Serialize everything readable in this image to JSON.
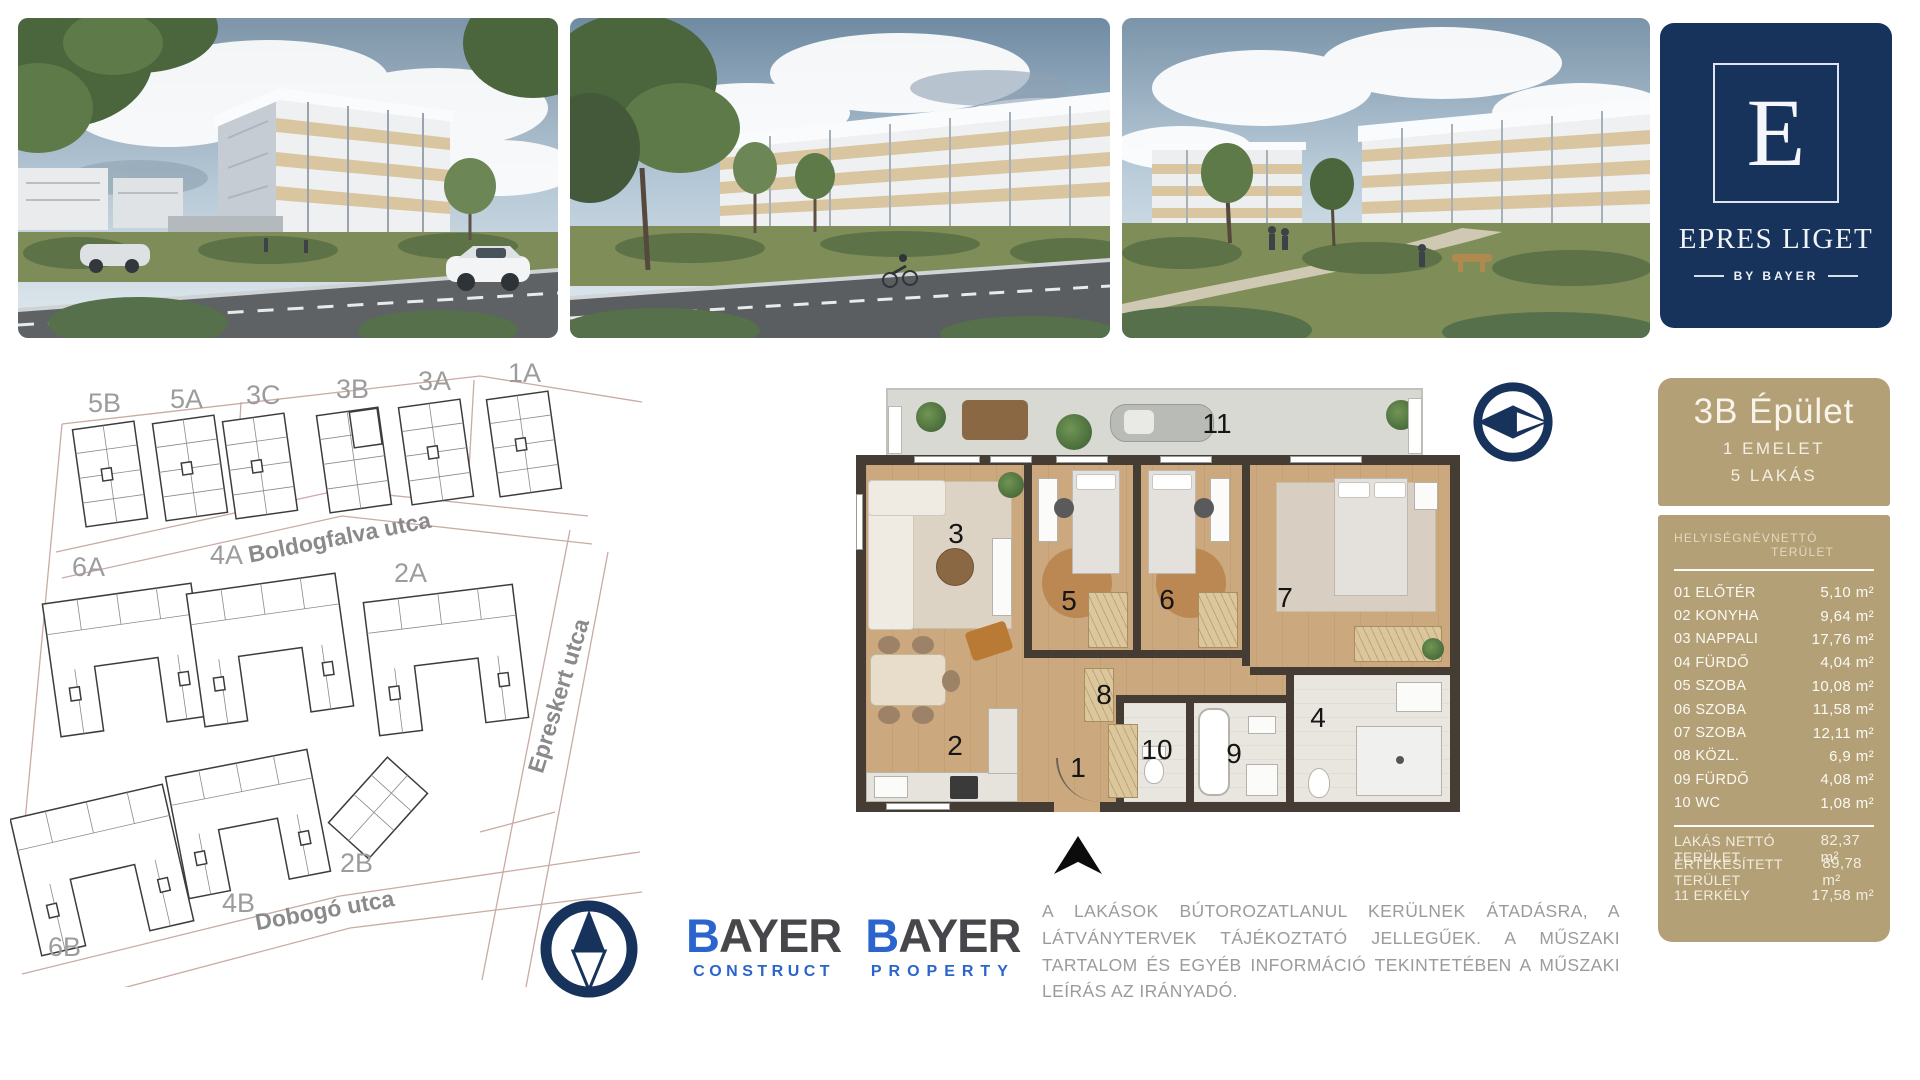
{
  "brand_panel": {
    "letter": "E",
    "name": "EPRES LIGET",
    "byline": "BY BAYER"
  },
  "photos": [
    {
      "name": "exterior-render-corner-building"
    },
    {
      "name": "exterior-render-street-view"
    },
    {
      "name": "exterior-render-courtyard-view"
    }
  ],
  "site_map": {
    "building_labels": [
      "5B",
      "5A",
      "3C",
      "3B",
      "3A",
      "1A",
      "6A",
      "4A",
      "2A",
      "2B",
      "4B",
      "6B"
    ],
    "street_labels": [
      "Boldogfalva utca",
      "Epreskert utca",
      "Dobogó utca"
    ],
    "highlighted_building": "3B"
  },
  "floor_plan": {
    "numbers": [
      "1",
      "2",
      "3",
      "4",
      "5",
      "6",
      "7",
      "8",
      "9",
      "10",
      "11"
    ]
  },
  "unit_panel": {
    "title": "3B Épület",
    "floor_line": "1 EMELET",
    "units_line": "5 LAKÁS",
    "columns": {
      "name": "HELYISÉGNÉV",
      "area": "NETTÓ TERÜLET"
    },
    "rooms": [
      {
        "name": "01 ELŐTÉR",
        "area": "5,10 m²"
      },
      {
        "name": "02 KONYHA",
        "area": "9,64 m²"
      },
      {
        "name": "03 NAPPALI",
        "area": "17,76 m²"
      },
      {
        "name": "04 FÜRDŐ",
        "area": "4,04 m²"
      },
      {
        "name": "05 SZOBA",
        "area": "10,08 m²"
      },
      {
        "name": "06 SZOBA",
        "area": "11,58 m²"
      },
      {
        "name": "07 SZOBA",
        "area": "12,11 m²"
      },
      {
        "name": "08 KÖZL.",
        "area": "6,9 m²"
      },
      {
        "name": "09 FÜRDŐ",
        "area": "4,08 m²"
      },
      {
        "name": "10 WC",
        "area": "1,08 m²"
      }
    ],
    "totals": [
      {
        "name": "LAKÁS NETTÓ TERÜLET",
        "area": "82,37 m²"
      },
      {
        "name": "ÉRTÉKESÍTETT TERÜLET",
        "area": "89,78 m²"
      },
      {
        "name": "11 ERKÉLY",
        "area": "17,58 m²"
      }
    ]
  },
  "partners": {
    "construct": {
      "b": "B",
      "rest": "AYER",
      "sub": "CONSTRUCT"
    },
    "property": {
      "b": "B",
      "rest": "AYER",
      "sub": "PROPERTY"
    }
  },
  "disclaimer": "A LAKÁSOK BÚTOROZATLANUL KERÜLNEK ÁTADÁSRA, A LÁTVÁNYTERVEK TÁJÉKOZTATÓ JELLEGŰEK. A MŰSZAKI TARTALOM ÉS EGYÉB INFORMÁCIÓ TEKINTETÉBEN A MŰSZAKI LEÍRÁS AZ IRÁNYADÓ.",
  "colors": {
    "navy": "#17335b",
    "gold": "#b3a077",
    "bayer_blue": "#2a64cc"
  },
  "icons": {
    "plan_compass": "compass-eye-icon",
    "north_compass": "north-arrow-icon",
    "entrance": "entrance-arrow-icon"
  }
}
